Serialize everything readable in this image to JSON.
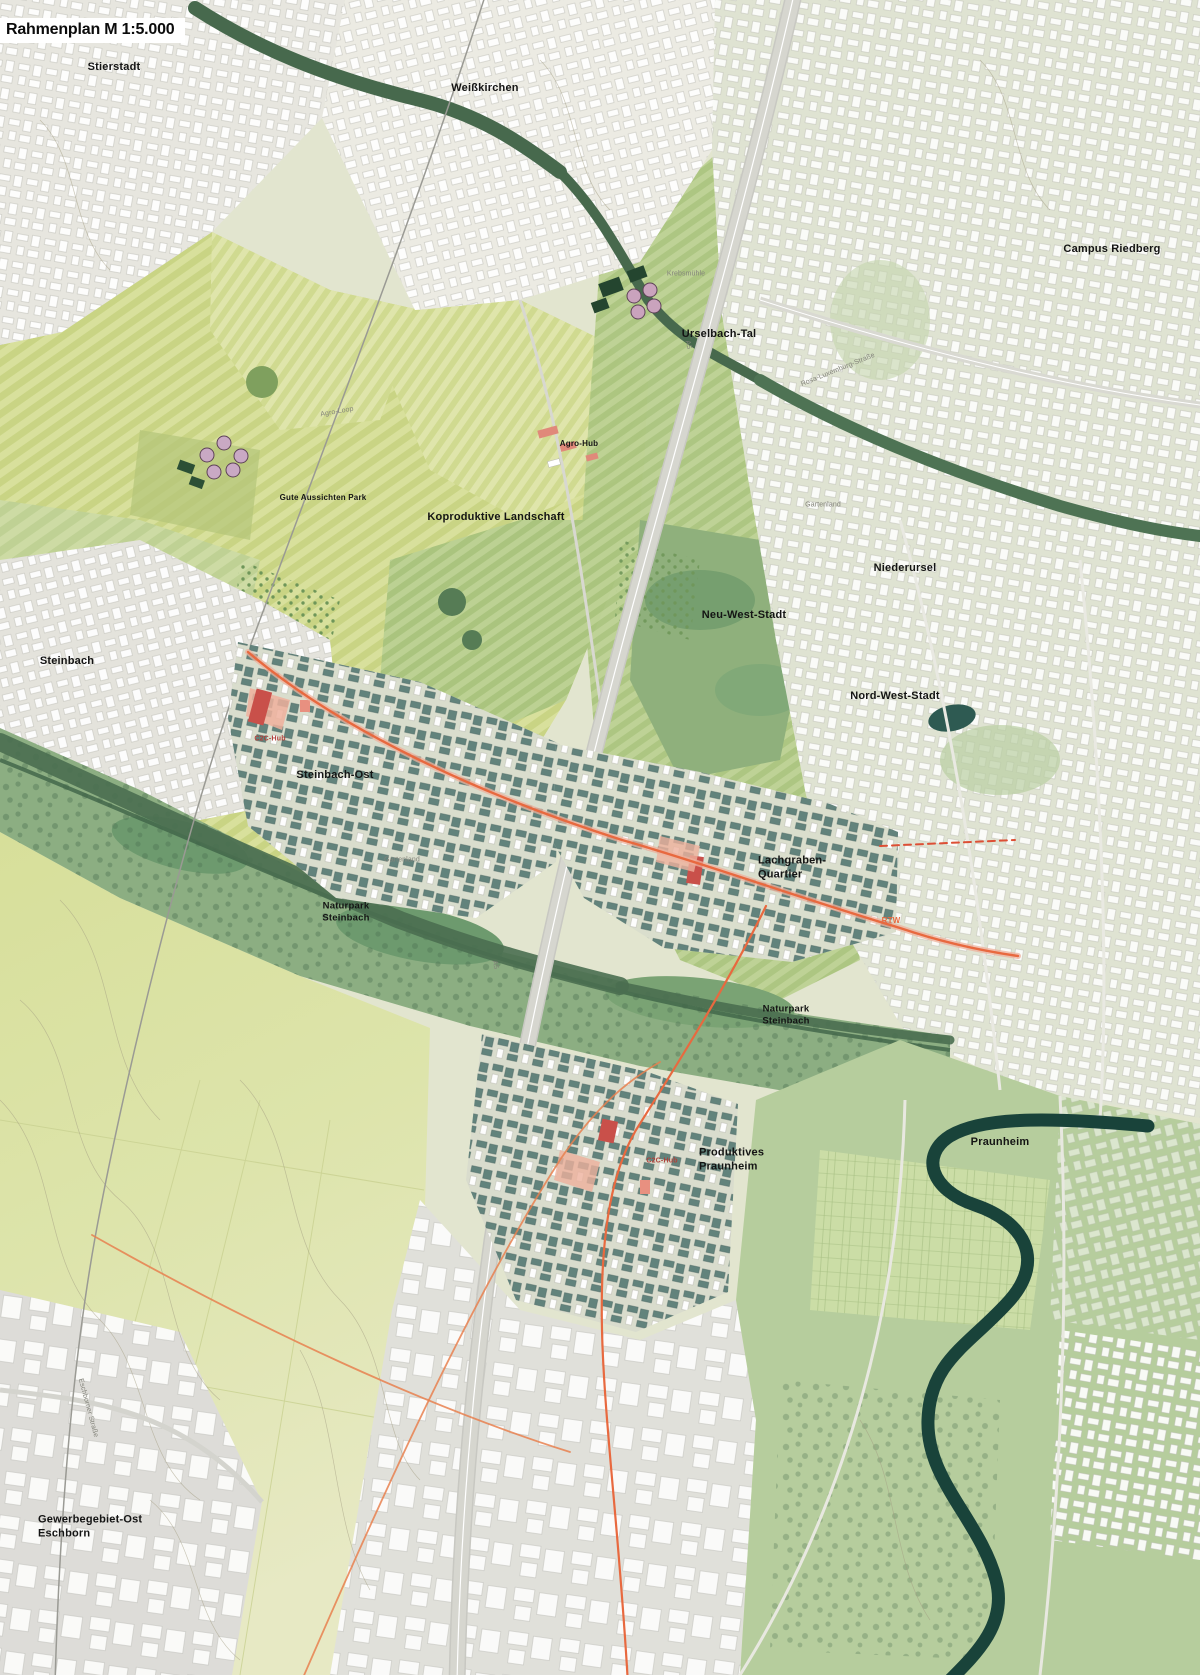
{
  "title": "Rahmenplan M 1:5.000",
  "map": {
    "place_labels": [
      {
        "id": "stierstadt",
        "text": "Stierstadt",
        "x": 114,
        "y": 67,
        "size": 11
      },
      {
        "id": "weisskirchen",
        "text": "Weißkirchen",
        "x": 485,
        "y": 88,
        "size": 11
      },
      {
        "id": "campus-riedberg",
        "text": "Campus Riedberg",
        "x": 1112,
        "y": 249,
        "size": 11
      },
      {
        "id": "urselbach-tal",
        "text": "Urselbach-Tal",
        "x": 719,
        "y": 334,
        "size": 11
      },
      {
        "id": "agro-hub",
        "text": "Agro-Hub",
        "x": 579,
        "y": 444,
        "size": 8
      },
      {
        "id": "gute-aussichten-park",
        "text": "Gute Aussichten Park",
        "x": 323,
        "y": 498,
        "size": 8
      },
      {
        "id": "koproduktive-landschaft",
        "text": "Koproduktive Landschaft",
        "x": 496,
        "y": 517,
        "size": 11
      },
      {
        "id": "niederursel",
        "text": "Niederursel",
        "x": 905,
        "y": 568,
        "size": 11
      },
      {
        "id": "neu-west-stadt",
        "text": "Neu-West-Stadt",
        "x": 744,
        "y": 615,
        "size": 11
      },
      {
        "id": "nord-west-stadt",
        "text": "Nord-West-Stadt",
        "x": 895,
        "y": 696,
        "size": 11
      },
      {
        "id": "steinbach",
        "text": "Steinbach",
        "x": 67,
        "y": 661,
        "size": 11
      },
      {
        "id": "steinbach-ost",
        "text": "Steinbach-Ost",
        "x": 335,
        "y": 775,
        "size": 11
      },
      {
        "id": "lachgraben-quartier",
        "lines": [
          "Lachgraben-",
          "Quartier"
        ],
        "x": 758,
        "y": 868,
        "size": 11,
        "align": "left"
      },
      {
        "id": "naturpark-steinbach-west",
        "lines": [
          "Naturpark",
          "Steinbach"
        ],
        "x": 346,
        "y": 913,
        "size": 9.5,
        "align": "center"
      },
      {
        "id": "naturpark-steinbach-ost",
        "lines": [
          "Naturpark",
          "Steinbach"
        ],
        "x": 786,
        "y": 1016,
        "size": 9.5,
        "align": "center"
      },
      {
        "id": "praunheim",
        "text": "Praunheim",
        "x": 1000,
        "y": 1142,
        "size": 11
      },
      {
        "id": "produktives-praunheim",
        "lines": [
          "Produktives",
          "Praunheim"
        ],
        "x": 699,
        "y": 1160,
        "size": 11,
        "align": "left"
      },
      {
        "id": "gewerbegebiet-ost-eschborn",
        "lines": [
          "Gewerbegebiet-Ost",
          "Eschborn"
        ],
        "x": 38,
        "y": 1527,
        "size": 11,
        "align": "left"
      }
    ],
    "minor_labels": [
      {
        "id": "krebsmuehle",
        "text": "Krebsmühle",
        "x": 686,
        "y": 274
      },
      {
        "id": "agro-loop",
        "text": "Agro-Loop",
        "x": 337,
        "y": 412,
        "rotate": -10
      },
      {
        "id": "gartenland-nord",
        "text": "Gartenland",
        "x": 823,
        "y": 505
      },
      {
        "id": "gartenland-sued",
        "text": "Gartenland",
        "x": 402,
        "y": 860
      },
      {
        "id": "rosa-luxemburg-strasse",
        "text": "Rosa-Luxemburg-Straße",
        "x": 838,
        "y": 370,
        "rotate": -22
      },
      {
        "id": "eschborner-strasse",
        "text": "Eschborner Straße",
        "x": 88,
        "y": 1408,
        "rotate": 75
      },
      {
        "id": "a5-nord",
        "text": "A5",
        "x": 688,
        "y": 345,
        "rotate": 78
      },
      {
        "id": "a5-sued",
        "text": "A5",
        "x": 495,
        "y": 965,
        "rotate": 78
      }
    ],
    "accent_labels": [
      {
        "id": "c2c-hub-steinbach",
        "text": "C2C-Hub",
        "x": 270,
        "y": 739,
        "color": "#b0403a",
        "size": 7
      },
      {
        "id": "c2c-hub-praunheim",
        "text": "C2C-Hub",
        "x": 662,
        "y": 1161,
        "color": "#b0403a",
        "size": 7
      },
      {
        "id": "rtw",
        "text": "RTW",
        "x": 891,
        "y": 921,
        "color": "#e8693f",
        "size": 8
      }
    ],
    "colors": {
      "field_yellow": "#d8e09c",
      "field_green": "#bcd193",
      "forest_green": "#47694d",
      "naturpark_green": "#8cae82",
      "urban_ground": "#dfe3d2",
      "building_white": "#ffffff",
      "quarter_teal": "#5c7e78",
      "accent_red": "#c9504a",
      "salmon": "#eeb09c",
      "transit_orange": "#e8693f",
      "water_dark": "#19433a",
      "highway_gray": "#d6d6cf"
    }
  }
}
